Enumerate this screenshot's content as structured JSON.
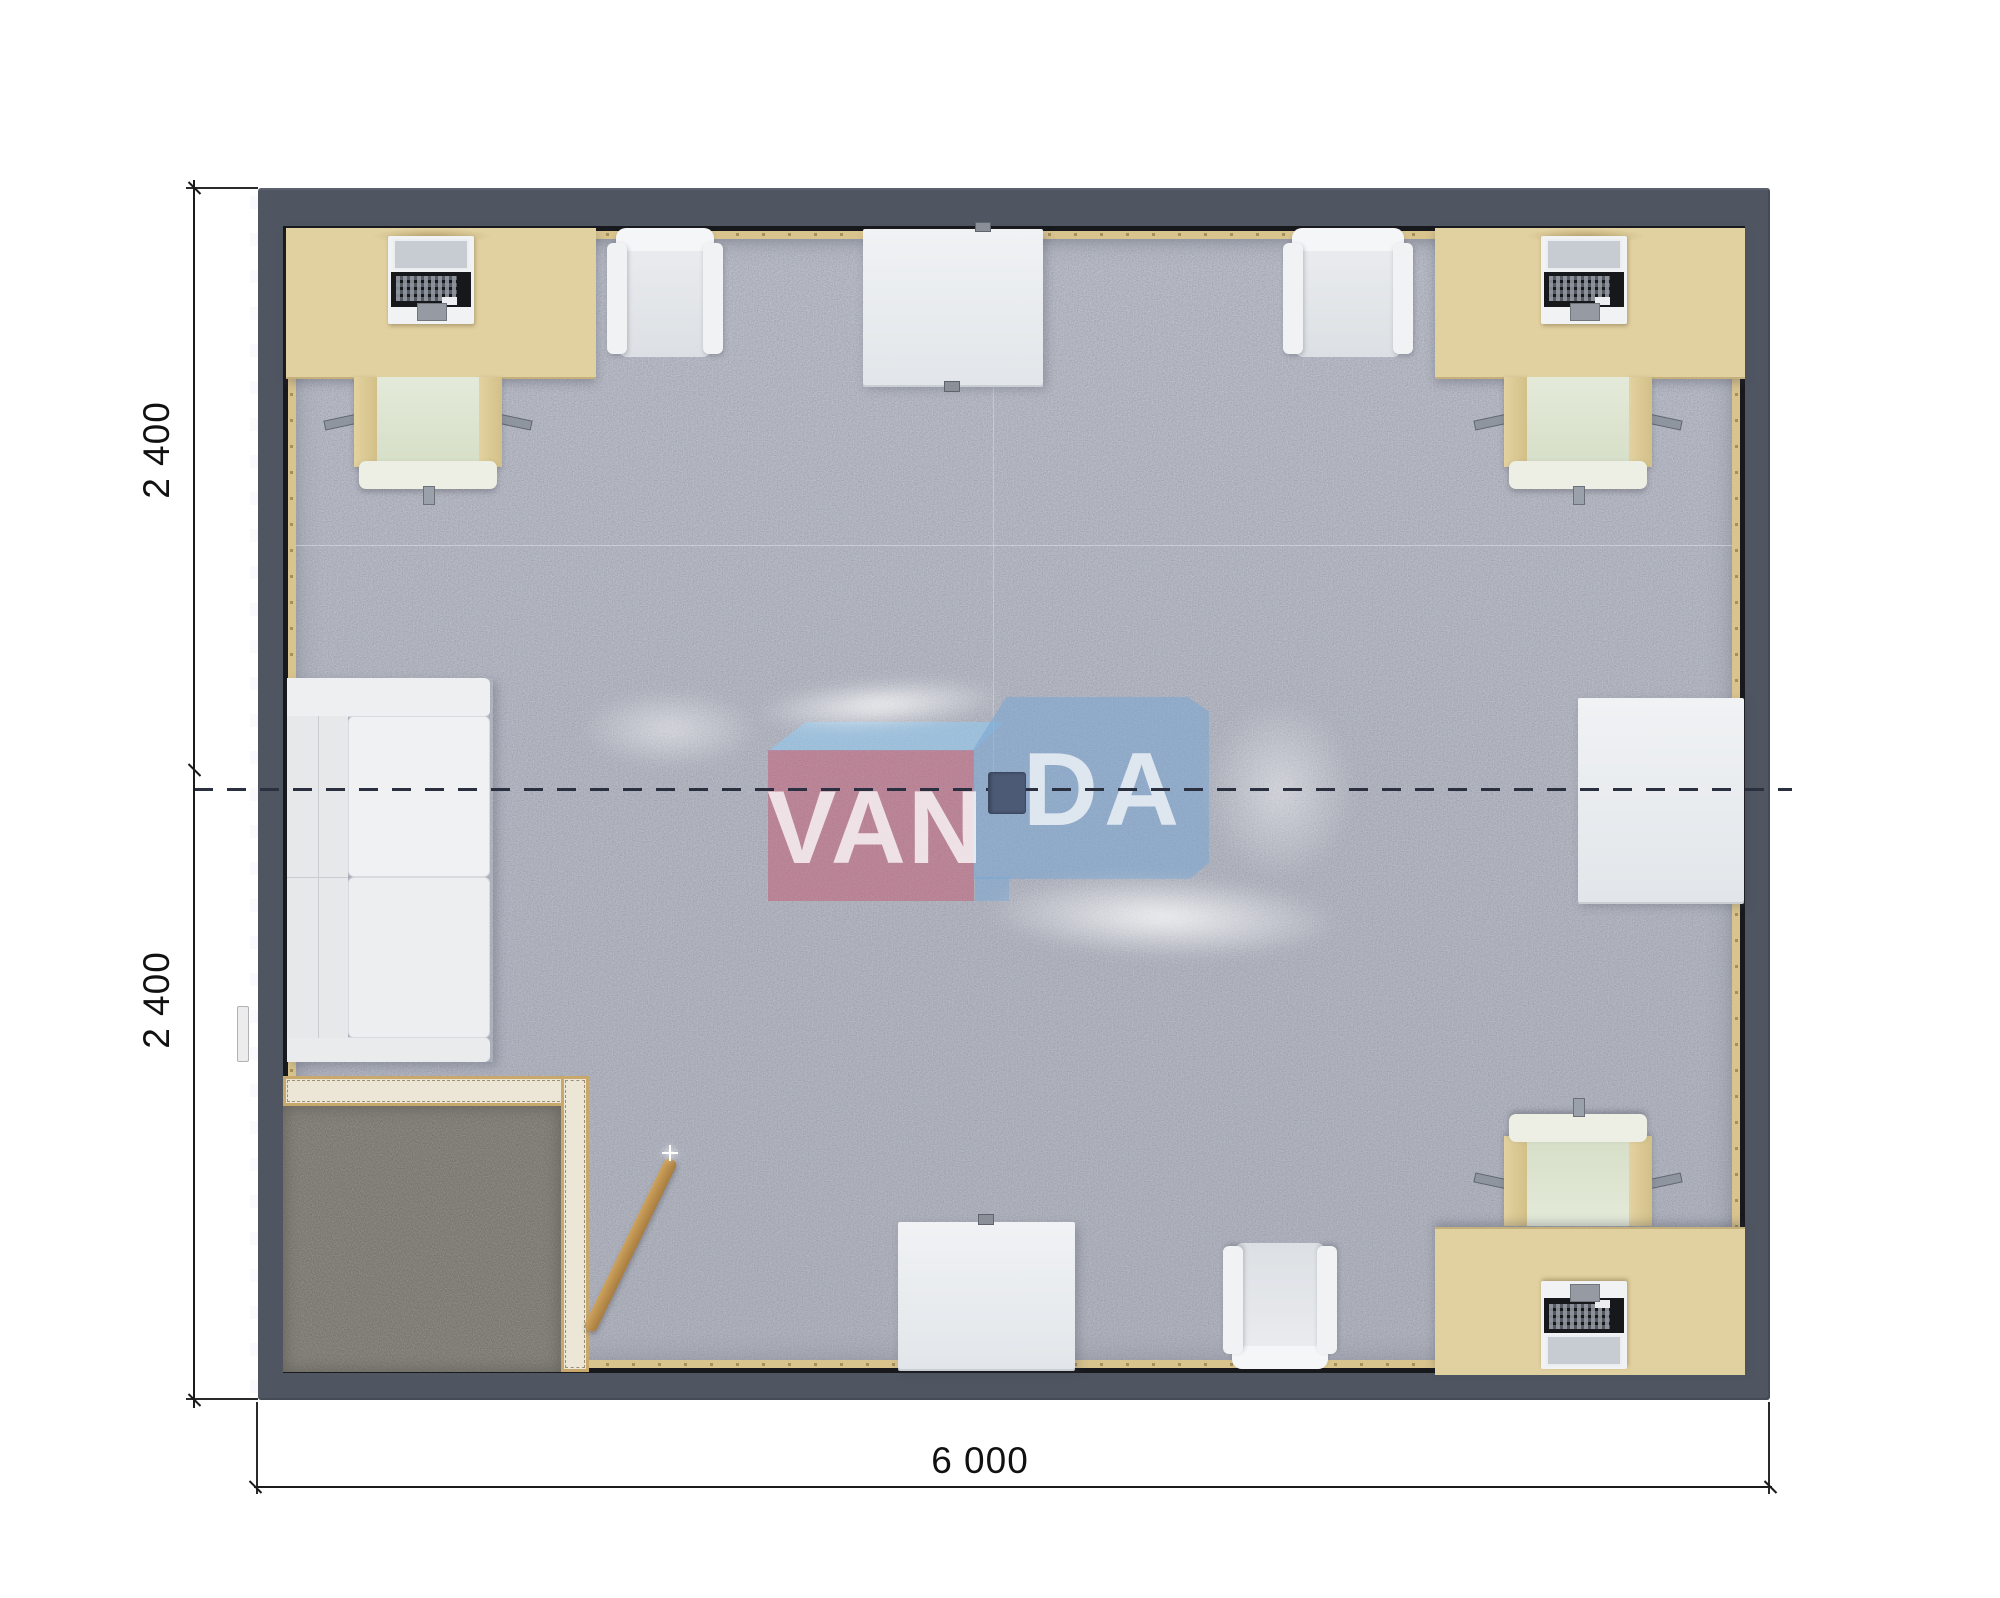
{
  "plan": {
    "type": "modular office container floor plan, top view render",
    "dimensions": {
      "left_module_top": "2 400",
      "left_module_bottom": "2 400",
      "bottom_total": "6 000"
    },
    "watermark": {
      "left_text": "VAN",
      "right_text": "DA",
      "pink_box_color": "#c65972",
      "blue_box_color": "#7aa5d3",
      "top_face_color": "#94c8ee"
    },
    "colors": {
      "background": "#ffffff",
      "wall": "#4f5661",
      "carpet": "#b8bbc5",
      "entry_mat": "#8f8d85",
      "desk_wood": "#e2d1a0",
      "chair_cushion": "#dde4d1",
      "partition_wall": "#ebe6d6",
      "partition_edge": "#c9a86c",
      "white_furniture": "#eef0f2",
      "dimension_line": "#1b1b1b",
      "module_joint_dash": "#2a3040",
      "center_unit": "#4c5a75"
    },
    "furniture_inventory": {
      "desks_with_computers": 3,
      "task_chairs": 3,
      "armchairs": 3,
      "white_tables": 3,
      "sofa": 1,
      "entry_vestibule_mat": 1,
      "leaning_broom": 1
    }
  }
}
